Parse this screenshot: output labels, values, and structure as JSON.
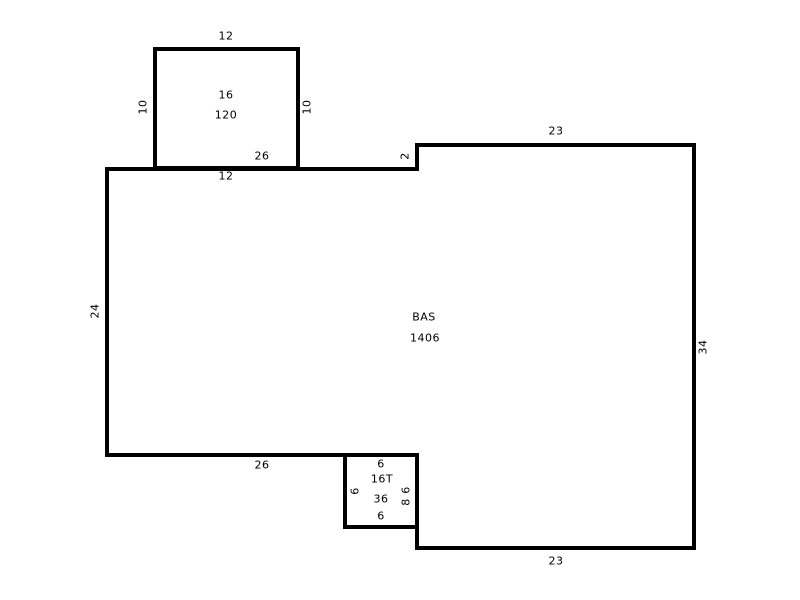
{
  "canvas": {
    "width": 800,
    "height": 600
  },
  "colors": {
    "background": "#ffffff",
    "line": "#000000",
    "text": "#000000"
  },
  "diagram": {
    "type": "floor-plan-sketch",
    "areas": [
      {
        "name": "area-16",
        "code": "16",
        "size": "120",
        "outline": [
          [
            155,
            49
          ],
          [
            298,
            49
          ],
          [
            298,
            168
          ],
          [
            155,
            168
          ]
        ]
      },
      {
        "name": "area-bas",
        "code": "BAS",
        "size": "1406",
        "outline": [
          [
            107,
            169
          ],
          [
            417,
            169
          ],
          [
            417,
            145
          ],
          [
            694,
            145
          ],
          [
            694,
            548
          ],
          [
            417,
            548
          ],
          [
            417,
            455
          ],
          [
            107,
            455
          ]
        ]
      },
      {
        "name": "area-16t",
        "code": "16T",
        "size": "36",
        "outline": [
          [
            345,
            455
          ],
          [
            417,
            455
          ],
          [
            417,
            527
          ],
          [
            345,
            527
          ]
        ]
      }
    ],
    "labels": [
      {
        "text": "12",
        "x": 226,
        "y": 36,
        "rot": 0,
        "kind": "dimension-label"
      },
      {
        "text": "10",
        "x": 143,
        "y": 107,
        "rot": -90,
        "kind": "dimension-label"
      },
      {
        "text": "10",
        "x": 307,
        "y": 107,
        "rot": -90,
        "kind": "dimension-label"
      },
      {
        "text": "16",
        "x": 226,
        "y": 95,
        "rot": 0,
        "kind": "area-name-label"
      },
      {
        "text": "120",
        "x": 226,
        "y": 115,
        "rot": 0,
        "kind": "area-size-label"
      },
      {
        "text": "26",
        "x": 262,
        "y": 156,
        "rot": 0,
        "kind": "dimension-label"
      },
      {
        "text": "12",
        "x": 226,
        "y": 176,
        "rot": 0,
        "kind": "dimension-label"
      },
      {
        "text": "2",
        "x": 405,
        "y": 156,
        "rot": -90,
        "kind": "dimension-label"
      },
      {
        "text": "23",
        "x": 556,
        "y": 131,
        "rot": 0,
        "kind": "dimension-label"
      },
      {
        "text": "34",
        "x": 703,
        "y": 347,
        "rot": -90,
        "kind": "dimension-label"
      },
      {
        "text": "24",
        "x": 95,
        "y": 311,
        "rot": -90,
        "kind": "dimension-label"
      },
      {
        "text": "BAS",
        "x": 424,
        "y": 317,
        "rot": 0,
        "kind": "area-name-label"
      },
      {
        "text": "1406",
        "x": 425,
        "y": 338,
        "rot": 0,
        "kind": "area-size-label"
      },
      {
        "text": "26",
        "x": 262,
        "y": 465,
        "rot": 0,
        "kind": "dimension-label"
      },
      {
        "text": "6",
        "x": 381,
        "y": 464,
        "rot": 0,
        "kind": "dimension-label"
      },
      {
        "text": "16T",
        "x": 382,
        "y": 479,
        "rot": 0,
        "kind": "area-name-label"
      },
      {
        "text": "36",
        "x": 381,
        "y": 499,
        "rot": 0,
        "kind": "area-size-label"
      },
      {
        "text": "6",
        "x": 381,
        "y": 516,
        "rot": 0,
        "kind": "dimension-label"
      },
      {
        "text": "6",
        "x": 355,
        "y": 491,
        "rot": -90,
        "kind": "dimension-label"
      },
      {
        "text": "6",
        "x": 406,
        "y": 490,
        "rot": -90,
        "kind": "dimension-label"
      },
      {
        "text": "8",
        "x": 406,
        "y": 502,
        "rot": -90,
        "kind": "dimension-label"
      },
      {
        "text": "23",
        "x": 556,
        "y": 561,
        "rot": 0,
        "kind": "dimension-label"
      }
    ]
  }
}
